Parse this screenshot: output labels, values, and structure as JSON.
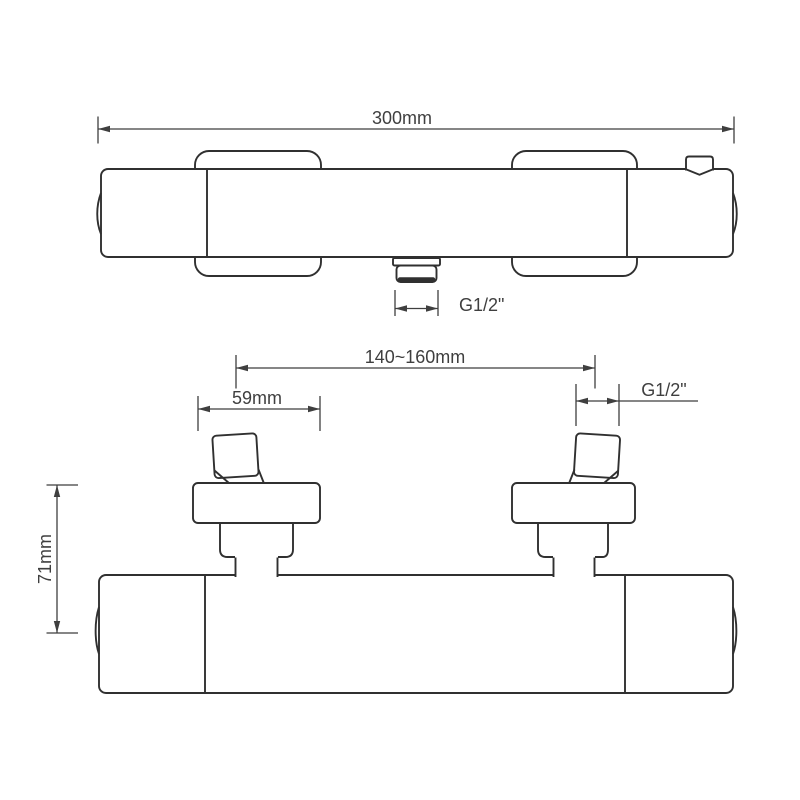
{
  "canvas": {
    "background": "#ffffff",
    "object_line_color": "#303030",
    "dimension_line_color": "#3f3f3f"
  },
  "top_view": {
    "dim_overall_width": "300mm",
    "dim_outlet_thread": "G1/2\""
  },
  "front_view": {
    "dim_inlet_spacing": "140~160mm",
    "dim_flange_width": "59mm",
    "dim_inlet_thread": "G1/2\"",
    "dim_height": "71mm"
  }
}
